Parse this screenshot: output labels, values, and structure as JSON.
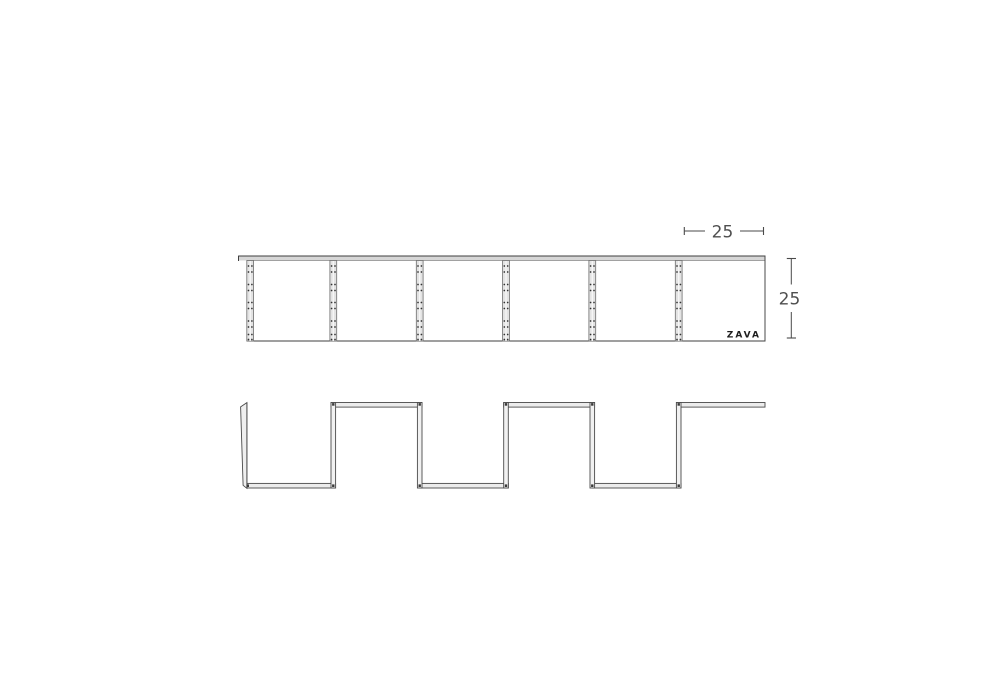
{
  "drawing": {
    "brand": "ZAVA",
    "dim_width": "25",
    "dim_height": "25",
    "panel_count": 6,
    "views": {
      "top_view": "row of 6 square shelf modules with jointed battens between panels",
      "front_view": "zigzag (square-wave) folded shelf profile"
    },
    "colors": {
      "background": "#ffffff",
      "line": "#454545",
      "fill_strip": "#d6d6d6",
      "fill_batten": "#e3e3e3",
      "fill_shelf": "#ececec",
      "dim_text": "#4f4f4f",
      "logo_text": "#1d1d1d"
    }
  }
}
